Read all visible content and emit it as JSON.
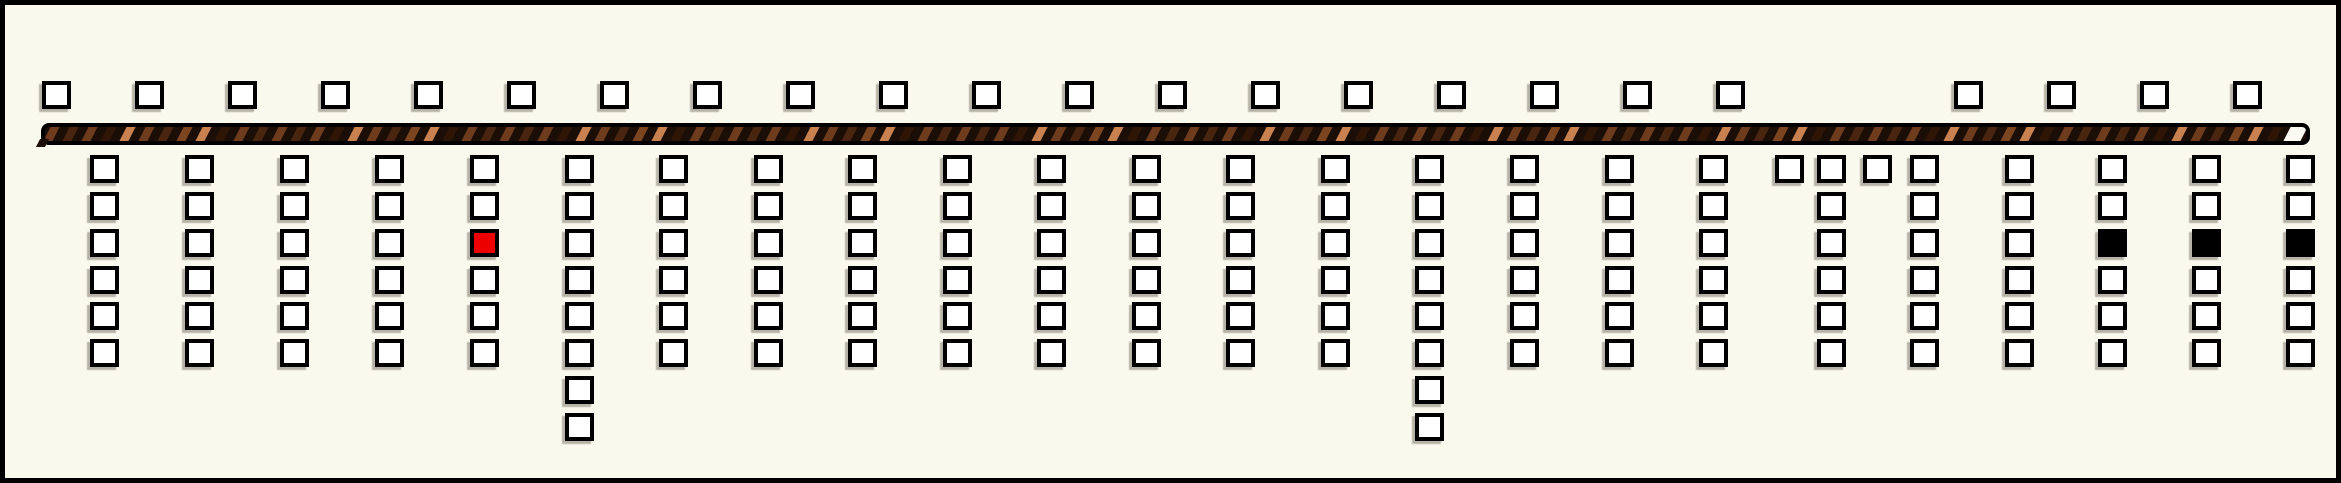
{
  "canvas": {
    "width": 2341,
    "height": 483,
    "background": "#FAF9EE",
    "border_color": "#000000",
    "border_width": 5
  },
  "square": {
    "width": 29,
    "height": 28,
    "border_width": 4,
    "border_color": "#000000",
    "fill_white": "#FFFFFF",
    "fill_red": "#ED0000",
    "fill_black": "#000000"
  },
  "top_row": {
    "y": 76,
    "xs": [
      37,
      130,
      223,
      316,
      409,
      502,
      595,
      688,
      781,
      874,
      967,
      1060,
      1153,
      1246,
      1339,
      1432,
      1525,
      1618,
      1711,
      1949,
      2042,
      2135,
      2228
    ]
  },
  "bar": {
    "x": 36,
    "y": 118,
    "width": 2269,
    "height": 22,
    "border_width": 4,
    "border_color": "#000000",
    "corner_radius": 8,
    "background": "#1B0E06",
    "stripe_width": 9,
    "stripe_gap": 10,
    "skew_deg": -27,
    "stripe_colors": [
      "#6F3B1D",
      "#49240F",
      "#6F3B1D",
      "#2E1506",
      "#C9824F",
      "#6F3B1D",
      "#49240F",
      "#7C451F",
      "#C9824F",
      "#2E1506",
      "#6F3B1D",
      "#49240F"
    ],
    "end_cap_color": "#FBFAF2",
    "end_cap_width": 17
  },
  "grid": {
    "row_tops": [
      150,
      187,
      224,
      261,
      297,
      334,
      371,
      408
    ]
  },
  "cell_states": {
    "w": "white",
    "r": "red",
    "b": "black"
  },
  "columns": [
    {
      "x": 85,
      "cells": "wwwwww"
    },
    {
      "x": 180,
      "cells": "wwwwww"
    },
    {
      "x": 275,
      "cells": "wwwwww"
    },
    {
      "x": 370,
      "cells": "wwwwww"
    },
    {
      "x": 465,
      "cells": "wwrwww"
    },
    {
      "x": 560,
      "cells": "wwwwwwww"
    },
    {
      "x": 654,
      "cells": "wwwwww"
    },
    {
      "x": 749,
      "cells": "wwwwww"
    },
    {
      "x": 843,
      "cells": "wwwwww"
    },
    {
      "x": 938,
      "cells": "wwwwww"
    },
    {
      "x": 1032,
      "cells": "wwwwww"
    },
    {
      "x": 1127,
      "cells": "wwwwww"
    },
    {
      "x": 1221,
      "cells": "wwwwww"
    },
    {
      "x": 1316,
      "cells": "wwwwww"
    },
    {
      "x": 1410,
      "cells": "wwwwwwww"
    },
    {
      "x": 1505,
      "cells": "wwwwww"
    },
    {
      "x": 1600,
      "cells": "wwwwww"
    },
    {
      "x": 1694,
      "cells": "wwwwww"
    },
    {
      "x": 1770,
      "cells": "w"
    },
    {
      "x": 1812,
      "cells": "wwwwww"
    },
    {
      "x": 1858,
      "cells": "w"
    },
    {
      "x": 1905,
      "cells": "wwwwww"
    },
    {
      "x": 2000,
      "cells": "wwwwww"
    },
    {
      "x": 2093,
      "cells": "wwbwww"
    },
    {
      "x": 2187,
      "cells": "wwbwww"
    },
    {
      "x": 2281,
      "cells": "wwbwww"
    }
  ]
}
